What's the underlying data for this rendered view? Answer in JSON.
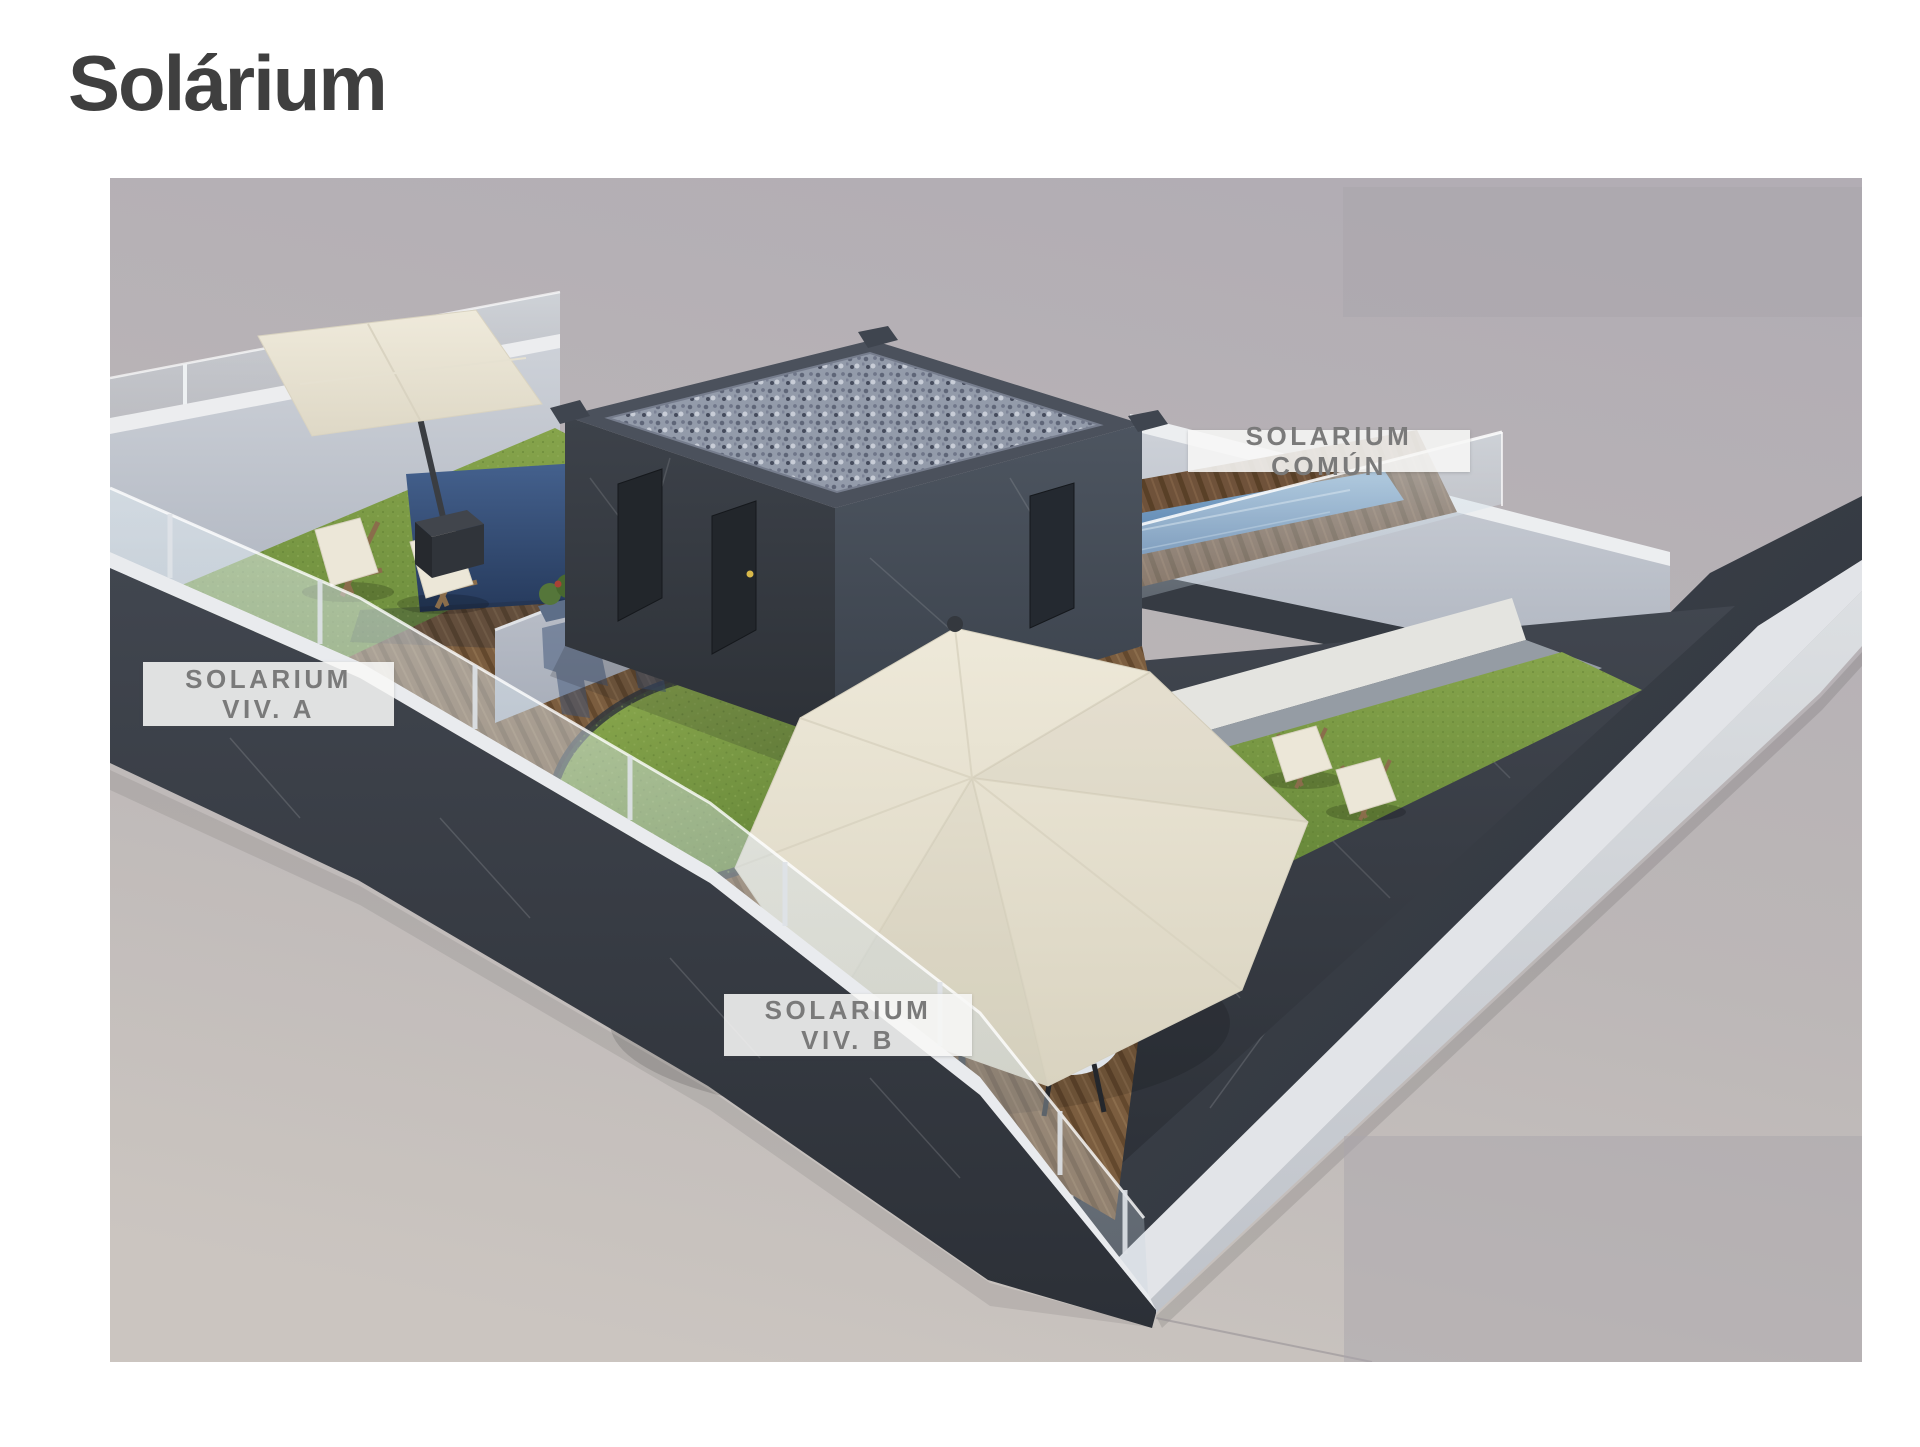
{
  "page": {
    "title": "Solárium"
  },
  "render": {
    "labels": {
      "comun": {
        "text": "SOLARIUM COMÚN"
      },
      "viv_a": {
        "line1": "SOLARIUM",
        "line2": "VIV. A"
      },
      "viv_b": {
        "line1": "SOLARIUM",
        "line2": "VIV. B"
      }
    }
  },
  "palette": {
    "page_bg": "#ffffff",
    "title_color": "#3f3f3f",
    "label_bg": "rgba(247,247,246,0.88)",
    "label_text": "#7a7a7a",
    "render_bg_top": "#b2adb4",
    "render_bg_bottom": "#cbc5c0",
    "overlay_gray": "#aaa5ac",
    "wood_deck": "#7b5d3f",
    "grass_green": "#77963f",
    "pool_water": "#5e85b0",
    "dark_marble": "#343941",
    "light_wall": "#c9cdd4",
    "cream_canvas": "#e9e4d4",
    "furniture_blue": "#3c5e94"
  }
}
